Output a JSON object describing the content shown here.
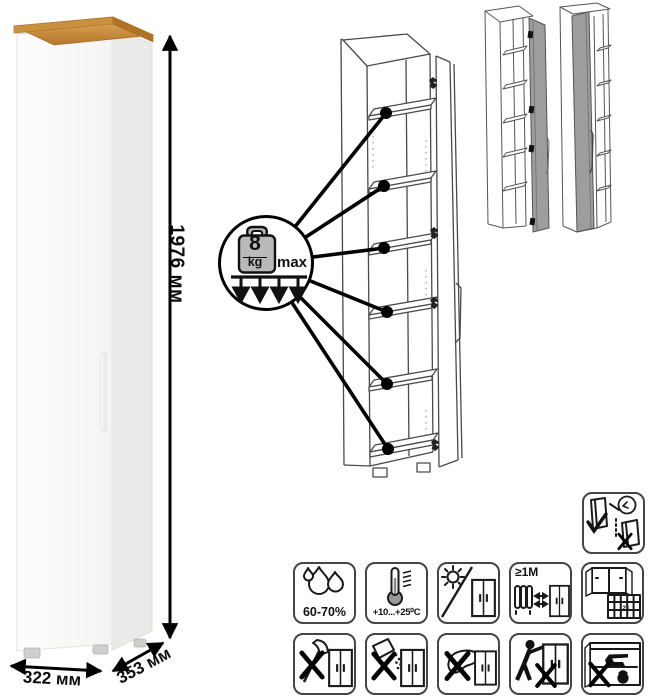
{
  "product": {
    "type": "tall-narrow-cabinet",
    "dimensions": {
      "height": "1976 мм",
      "width": "322 мм",
      "depth": "353 мм"
    }
  },
  "shelf_load_callout": {
    "value": "8",
    "unit": "kg",
    "qualifier": "max",
    "shelves_marked": 6
  },
  "variants": [
    "door-hinged-right-open",
    "door-hinged-left-open"
  ],
  "care_icons": {
    "humidity": "60-70%",
    "temperature": "+10...+25⁰C",
    "heat_distance": "≥1M",
    "ventilation_day": "21",
    "row1": [
      "humidity",
      "temperature",
      "no-direct-sunlight",
      "heat-distance",
      "ventilation"
    ],
    "row2": [
      "no-sharp-tools",
      "no-abrasive-cleaners",
      "no-wet-cleaning",
      "no-dragging",
      "no-overloading"
    ],
    "standalone": [
      "wall-anchoring-required"
    ]
  },
  "colors": {
    "wood_top": "#c9913f",
    "cabinet_white": "#f7f7f5",
    "side_shade": "#eaeae8",
    "drawing_line": "#4a4a4a",
    "variant_door_gray": "#9d9d9d",
    "mark_black": "#000000"
  }
}
